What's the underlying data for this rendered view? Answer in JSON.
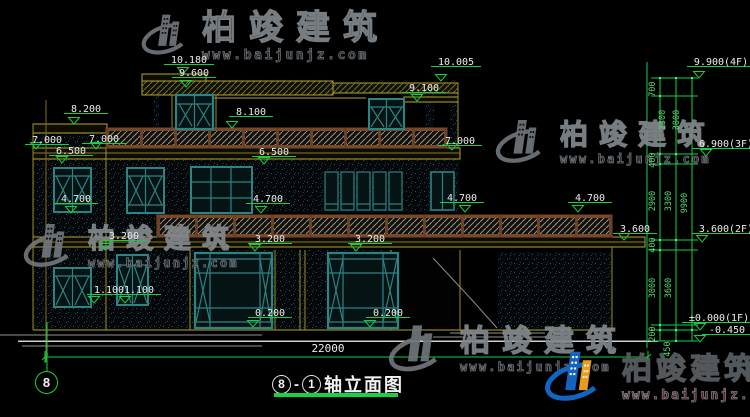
{
  "watermark": {
    "brand": "柏竣建筑",
    "url": "www.baijunjz.com"
  },
  "title": {
    "axis_start": "8",
    "dash": "-",
    "axis_end": "1",
    "text": "轴立面图"
  },
  "axis_bubble": "8",
  "annotations": {
    "level_markers": [
      {
        "t": "10.180",
        "x": 189,
        "y": 60,
        "tx": 183,
        "ty": 74
      },
      {
        "t": "9.600",
        "x": 194,
        "y": 73,
        "tx": 186,
        "ty": 87
      },
      {
        "t": "10.005",
        "x": 456,
        "y": 62,
        "tx": 441,
        "ty": 81
      },
      {
        "t": "9.100",
        "x": 424,
        "y": 88,
        "tx": 417,
        "ty": 101
      },
      {
        "t": "8.200",
        "x": 86,
        "y": 109,
        "tx": 74,
        "ty": 124
      },
      {
        "t": "8.100",
        "x": 251,
        "y": 112,
        "tx": 232,
        "ty": 128
      },
      {
        "t": "7.000",
        "x": 47,
        "y": 140,
        "tx": 36,
        "ty": 149
      },
      {
        "t": "7.000",
        "x": 104,
        "y": 139,
        "tx": 96,
        "ty": 149
      },
      {
        "t": "6.500",
        "x": 71,
        "y": 151,
        "tx": 62,
        "ty": 163
      },
      {
        "t": "6.500",
        "x": 274,
        "y": 152,
        "tx": 264,
        "ty": 164
      },
      {
        "t": "7.000",
        "x": 460,
        "y": 141,
        "tx": 452,
        "ty": 150
      },
      {
        "t": "4.700",
        "x": 76,
        "y": 199,
        "tx": 71,
        "ty": 213
      },
      {
        "t": "4.700",
        "x": 268,
        "y": 199,
        "tx": 261,
        "ty": 213
      },
      {
        "t": "4.700",
        "x": 462,
        "y": 198,
        "tx": 465,
        "ty": 212
      },
      {
        "t": "4.700",
        "x": 590,
        "y": 198,
        "tx": 578,
        "ty": 212
      },
      {
        "t": "3.600",
        "x": 635,
        "y": 229,
        "tx": 624,
        "ty": 240
      },
      {
        "t": "3.200",
        "x": 124,
        "y": 236,
        "tx": 105,
        "ty": 250
      },
      {
        "t": "3.200",
        "x": 270,
        "y": 239,
        "tx": 255,
        "ty": 251
      },
      {
        "t": "3.200",
        "x": 370,
        "y": 239,
        "tx": 356,
        "ty": 251
      },
      {
        "t": "1.100",
        "x": 109,
        "y": 290,
        "tx": 94,
        "ty": 303
      },
      {
        "t": "1.100",
        "x": 139,
        "y": 290,
        "tx": 125,
        "ty": 303
      },
      {
        "t": "0.200",
        "x": 270,
        "y": 313,
        "tx": 253,
        "ty": 327
      },
      {
        "t": "0.200",
        "x": 388,
        "y": 313,
        "tx": 370,
        "ty": 327
      },
      {
        "t": "9.900(4F)",
        "x": 721,
        "y": 62,
        "tx": 699,
        "ty": 78
      },
      {
        "t": "6.900(3F)",
        "x": 726,
        "y": 144,
        "tx": 706,
        "ty": 156
      },
      {
        "t": "3.600(2F)",
        "x": 726,
        "y": 229,
        "tx": 702,
        "ty": 242
      },
      {
        "t": "±0.000(1F)",
        "x": 719,
        "y": 318,
        "tx": 700,
        "ty": 330
      },
      {
        "t": "-0.450",
        "x": 727,
        "y": 330,
        "tx": 700,
        "ty": 342
      }
    ],
    "chain_dims": [
      {
        "t": "700",
        "x": 655,
        "y": 89
      },
      {
        "t": "2300",
        "x": 665,
        "y": 120
      },
      {
        "t": "3000",
        "x": 679,
        "y": 120
      },
      {
        "t": "400",
        "x": 655,
        "y": 160
      },
      {
        "t": "2900",
        "x": 655,
        "y": 201
      },
      {
        "t": "3300",
        "x": 671,
        "y": 201
      },
      {
        "t": "9900",
        "x": 687,
        "y": 203
      },
      {
        "t": "400",
        "x": 655,
        "y": 245
      },
      {
        "t": "3000",
        "x": 655,
        "y": 288
      },
      {
        "t": "3600",
        "x": 671,
        "y": 288
      },
      {
        "t": "200",
        "x": 655,
        "y": 334
      },
      {
        "t": "450",
        "x": 670,
        "y": 349
      }
    ],
    "plain_labels": [
      {
        "t": "22000",
        "x": 328,
        "y": 352
      }
    ]
  }
}
